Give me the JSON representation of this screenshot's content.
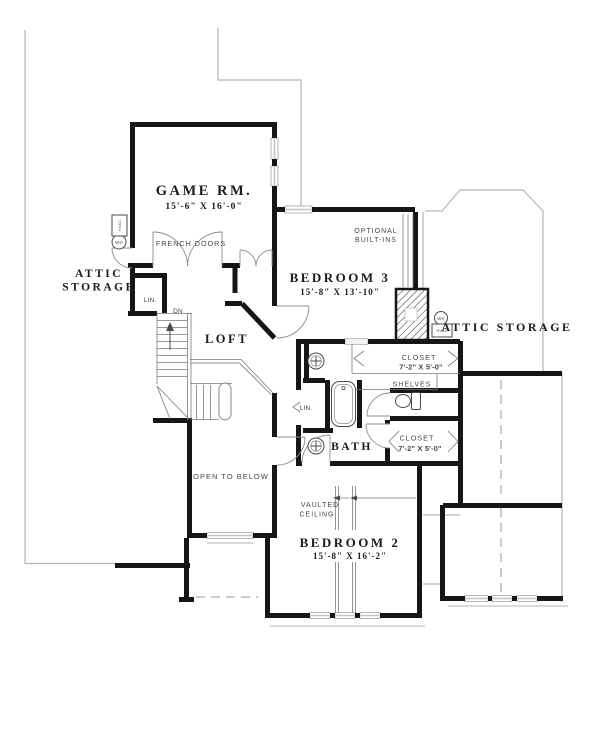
{
  "rooms": {
    "game_room": {
      "label": "GAME RM.",
      "dims": "15'-6\" X 16'-0\""
    },
    "bedroom_3": {
      "label": "BEDROOM 3",
      "dims": "15'-8\" X 13'-10\""
    },
    "bedroom_2": {
      "label": "BEDROOM 2",
      "dims": "15'-8\" X 16'-2\""
    },
    "loft": {
      "label": "LOFT"
    },
    "bath": {
      "label": "BATH"
    },
    "attic_storage_left": {
      "line1": "ATTIC",
      "line2": "STORAGE"
    },
    "attic_storage_right": {
      "label": "ATTIC STORAGE"
    },
    "closet_upper": {
      "label": "CLOSET",
      "dims": "7'-2\" X 5'-0\""
    },
    "closet_lower": {
      "label": "CLOSET",
      "dims": "7'-2\" X 5'-0\""
    }
  },
  "annotations": {
    "french_doors": "FRENCH DOORS",
    "optional_builtins_line1": "OPTIONAL",
    "optional_builtins_line2": "BUILT-INS",
    "shelves": "SHELVES",
    "linen_left": "LIN.",
    "linen_bath": "LIN.",
    "down": "DN",
    "open_to_below": "OPEN TO BELOW",
    "vaulted_line1": "VAULTED",
    "vaulted_line2": "CEILING"
  },
  "fixtures": {
    "water_heater": "WH",
    "hvac": "HVAC"
  },
  "colors": {
    "wall": "#161616",
    "thin_line": "#4a4a4a",
    "roof_outline": "#b5b5b5",
    "background": "#ffffff"
  }
}
